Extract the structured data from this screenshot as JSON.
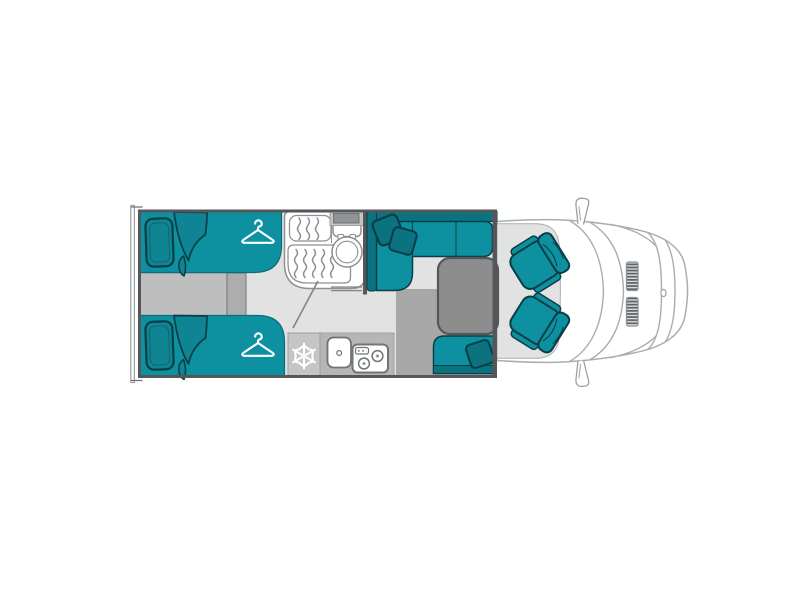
{
  "canvas": {
    "width": 800,
    "height": 600,
    "background": "#FFFFFF"
  },
  "labels": {
    "plan": "Motorhome floor plan, top view, cab facing right",
    "bed_top": "Single bed (rear, top)",
    "bed_bottom": "Single bed (rear, bottom)",
    "pillow": "Pillow",
    "blanket": "Folded blanket",
    "wardrobe": "Wardrobe hanger symbol",
    "step": "Step between beds",
    "bathroom": "Bathroom",
    "shower_tray_small": "Shower tray (small)",
    "shower_tray_large": "Shower tray (large)",
    "toilet": "Toilet",
    "overhead_locker": "Overhead locker",
    "door_swing": "Bathroom door swing",
    "fridge": "Fridge freezer",
    "counter": "Kitchen worktop",
    "sink": "Sink",
    "hob": "Two burner hob",
    "sofa": "L-shaped dinette sofa",
    "sofa_cushion": "Sofa cushion",
    "table": "Dinette table",
    "bench": "Side bench seat",
    "walkway": "Dinette floor area",
    "cab_floor": "Cab floor",
    "cab_seat_top": "Swivel cab seat (passenger)",
    "cab_seat_bottom": "Swivel cab seat (driver)",
    "vehicle_body": "Vehicle front exterior",
    "windshield": "Windscreen and bonnet lines",
    "grille": "Front grille vent",
    "badge": "Front badge",
    "mirror_top": "Side mirror",
    "mirror_bottom": "Side mirror",
    "rear_bumper": "Rear bumper",
    "wall": "Living area wall"
  },
  "floorplan": {
    "areas": {
      "bedroom": "Rear twin-bed bedroom with two wardrobes and center step",
      "bathroom": "Bathroom with two shower trays and toilet",
      "kitchen": "Kitchen with fridge, sink and two-burner hob",
      "dinette": "L-shaped dinette with table and side bench",
      "cab": "Driver cab with two swivel seats"
    },
    "icons": {
      "hanger": {
        "name": "hanger-icon",
        "meaning": "wardrobe"
      },
      "snowflake": {
        "name": "snowflake-icon",
        "meaning": "fridge-freezer"
      }
    }
  },
  "colors": {
    "white": "#FFFFFF",
    "teal": "#0D91A1",
    "tealMid": "#0E8494",
    "tealDark": "#0B7380",
    "tealPillow": "#0F8493",
    "tealOutline": "#093E47",
    "bedEdge": "#0A6C79",
    "wall": "#54565A",
    "floor": "#E2E2E2",
    "step": "#BEBEBE",
    "stepShade": "#ADADAD",
    "walkway": "#A7A7A7",
    "counter": "#B6B6B6",
    "fridge": "#C5C5C5",
    "table": "#8D8D8D",
    "locker": "#909294",
    "fixline": "#8C9195",
    "vanline": "#A9ADB0",
    "doorline": "#7E8487",
    "grayLine": "#9AA0A4",
    "darkLine": "#6F7477",
    "grilleLight": "#D8DADB",
    "grilleDark": "#5E6366",
    "icon": "#FFFFFF"
  }
}
